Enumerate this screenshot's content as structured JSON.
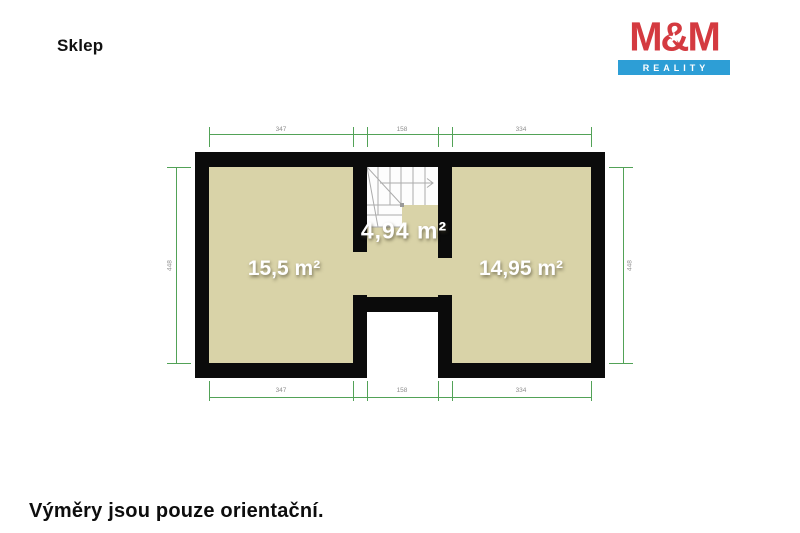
{
  "page": {
    "title": "Sklep",
    "footer_note": "Výměry jsou pouze orientační."
  },
  "logo": {
    "line1": "M&M",
    "line2": "REALITY",
    "star_icon": "★",
    "colors": {
      "logored": "#d43a40",
      "logoblue": "#2d9ed6"
    }
  },
  "plan": {
    "rooms": [
      {
        "id": "left-room",
        "area_label": "15,5 m²"
      },
      {
        "id": "stair-hall",
        "area_label": "4,94 m²"
      },
      {
        "id": "right-room",
        "area_label": "14,95 m²"
      }
    ],
    "dimensions": {
      "top": [
        "347",
        "158",
        "334"
      ],
      "bottom": [
        "347",
        "158",
        "334"
      ],
      "left": "448",
      "right": "448"
    },
    "colors": {
      "floor": "#d9d3a8",
      "wall": "#0b0b0b",
      "dimline": "#52a257",
      "dimtext": "#8f8f8f",
      "stairline": "#ababab"
    }
  }
}
